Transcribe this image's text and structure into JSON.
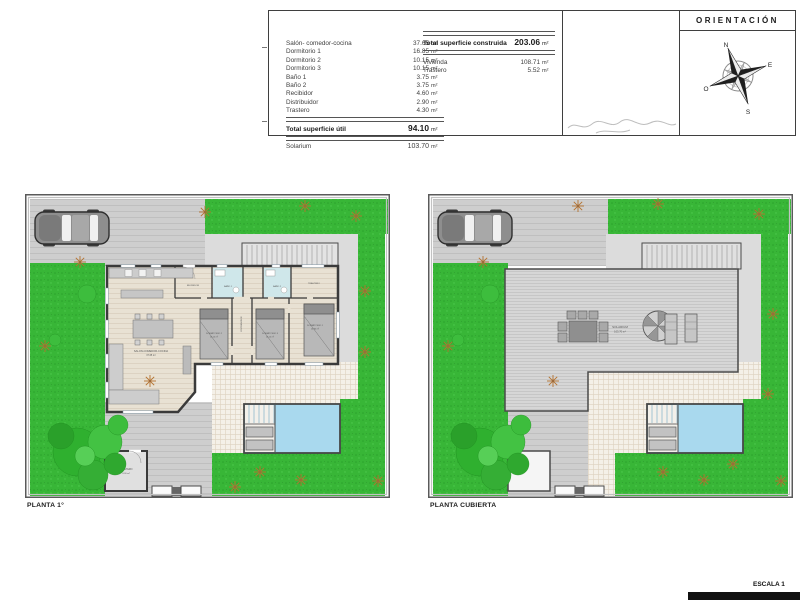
{
  "header": {
    "util_table": {
      "rows": [
        {
          "label": "Salón- comedor-cocina",
          "value": "37.65",
          "unit": "m²"
        },
        {
          "label": "Dormitorio 1",
          "value": "16.85",
          "unit": "m²"
        },
        {
          "label": "Dormitorio 2",
          "value": "10.15",
          "unit": "m²"
        },
        {
          "label": "Dormitorio 3",
          "value": "10.15",
          "unit": "m²"
        },
        {
          "label": "Baño 1",
          "value": "3.75",
          "unit": "m²"
        },
        {
          "label": "Baño 2",
          "value": "3.75",
          "unit": "m²"
        },
        {
          "label": "Recibidor",
          "value": "4.60",
          "unit": "m²"
        },
        {
          "label": "Distribuidor",
          "value": "2.90",
          "unit": "m²"
        },
        {
          "label": "Trastero",
          "value": "4.30",
          "unit": "m²"
        }
      ],
      "total": {
        "label": "Total superficie útil",
        "value": "94.10",
        "unit": "m²"
      },
      "solarium": {
        "label": "Solarium",
        "value": "103.70",
        "unit": "m²"
      }
    },
    "built_table": {
      "total": {
        "label": "Total superficie construida",
        "value": "203.06",
        "unit": "m²"
      },
      "rows": [
        {
          "label": "Vivienda",
          "value": "108.71",
          "unit": "m²"
        },
        {
          "label": "Trastero",
          "value": "5.52",
          "unit": "m²"
        }
      ]
    },
    "orientation": {
      "title": "ORIENTACIÓN",
      "n": "N",
      "e": "E",
      "s": "S",
      "o": "O"
    }
  },
  "plans": {
    "left": {
      "caption": "PLANTA 1°",
      "rooms": {
        "salon": "SALON-COMEDOR-COCINA",
        "salon_area": "37.65 m²",
        "dorm1": "DORMITORIO 1",
        "dorm1_area": "16.85 m²",
        "dorm2": "DORMITORIO 2",
        "dorm2_area": "10.15 m²",
        "dorm3": "DORMITORIO 3",
        "dorm3_area": "10.15 m²",
        "recibidor": "RECIBIDOR",
        "distribuidor": "DISTRIBUIDOR",
        "bano1": "BAÑO 1",
        "bano2": "BAÑO 2",
        "trastero": "TRASTERO",
        "trastero_area": "4.30 m²"
      }
    },
    "right": {
      "caption": "PLANTA CUBIERTA",
      "solarium": "SOLARIUM",
      "solarium_area": "103.70 m²"
    }
  },
  "footer": {
    "scale": "ESCALA 1"
  },
  "colors": {
    "grass": "#38b637",
    "driveway": "#cecece",
    "deck": "#f4f0e8",
    "pool_water": "#a9d9ee",
    "wall": "#3a3a3a",
    "wood_floor": "#e8e1d3",
    "bath_floor": "#cfe7ea",
    "footer_bar": "#111111"
  }
}
